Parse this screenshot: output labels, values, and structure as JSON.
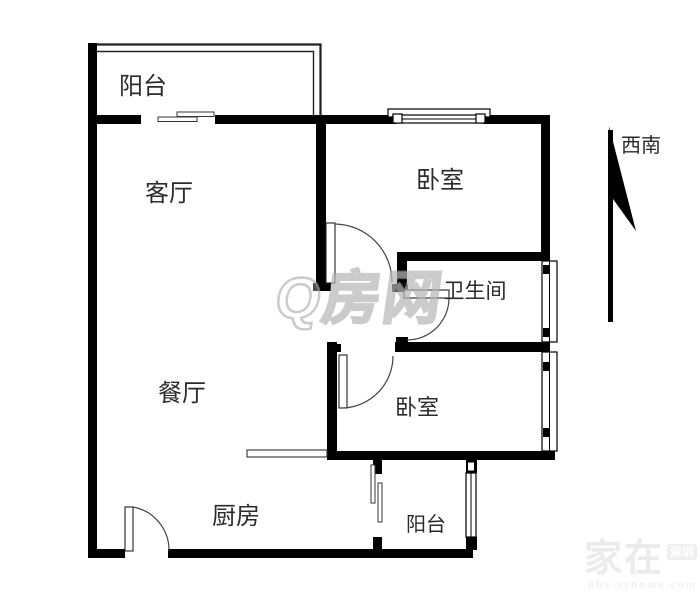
{
  "floor_plan": {
    "rooms": [
      {
        "id": "balcony-top",
        "label": "阳台"
      },
      {
        "id": "living-room",
        "label": "客厅"
      },
      {
        "id": "bedroom-top",
        "label": "卧室"
      },
      {
        "id": "bathroom",
        "label": "卫生间"
      },
      {
        "id": "dining-room",
        "label": "餐厅"
      },
      {
        "id": "bedroom-bottom",
        "label": "卧室"
      },
      {
        "id": "kitchen",
        "label": "厨房"
      },
      {
        "id": "balcony-bottom",
        "label": "阳台"
      }
    ],
    "compass": {
      "label": "西南"
    },
    "watermarks": {
      "center": "Q房网",
      "corner_main": "家在",
      "corner_tag": "深圳",
      "corner_sub": "bbs.szhome.com"
    },
    "colors": {
      "wall": "#000000",
      "text": "#2b2b2b",
      "thin_line": "#3a3a3a",
      "watermark_gray": "#a8a8a8"
    }
  }
}
